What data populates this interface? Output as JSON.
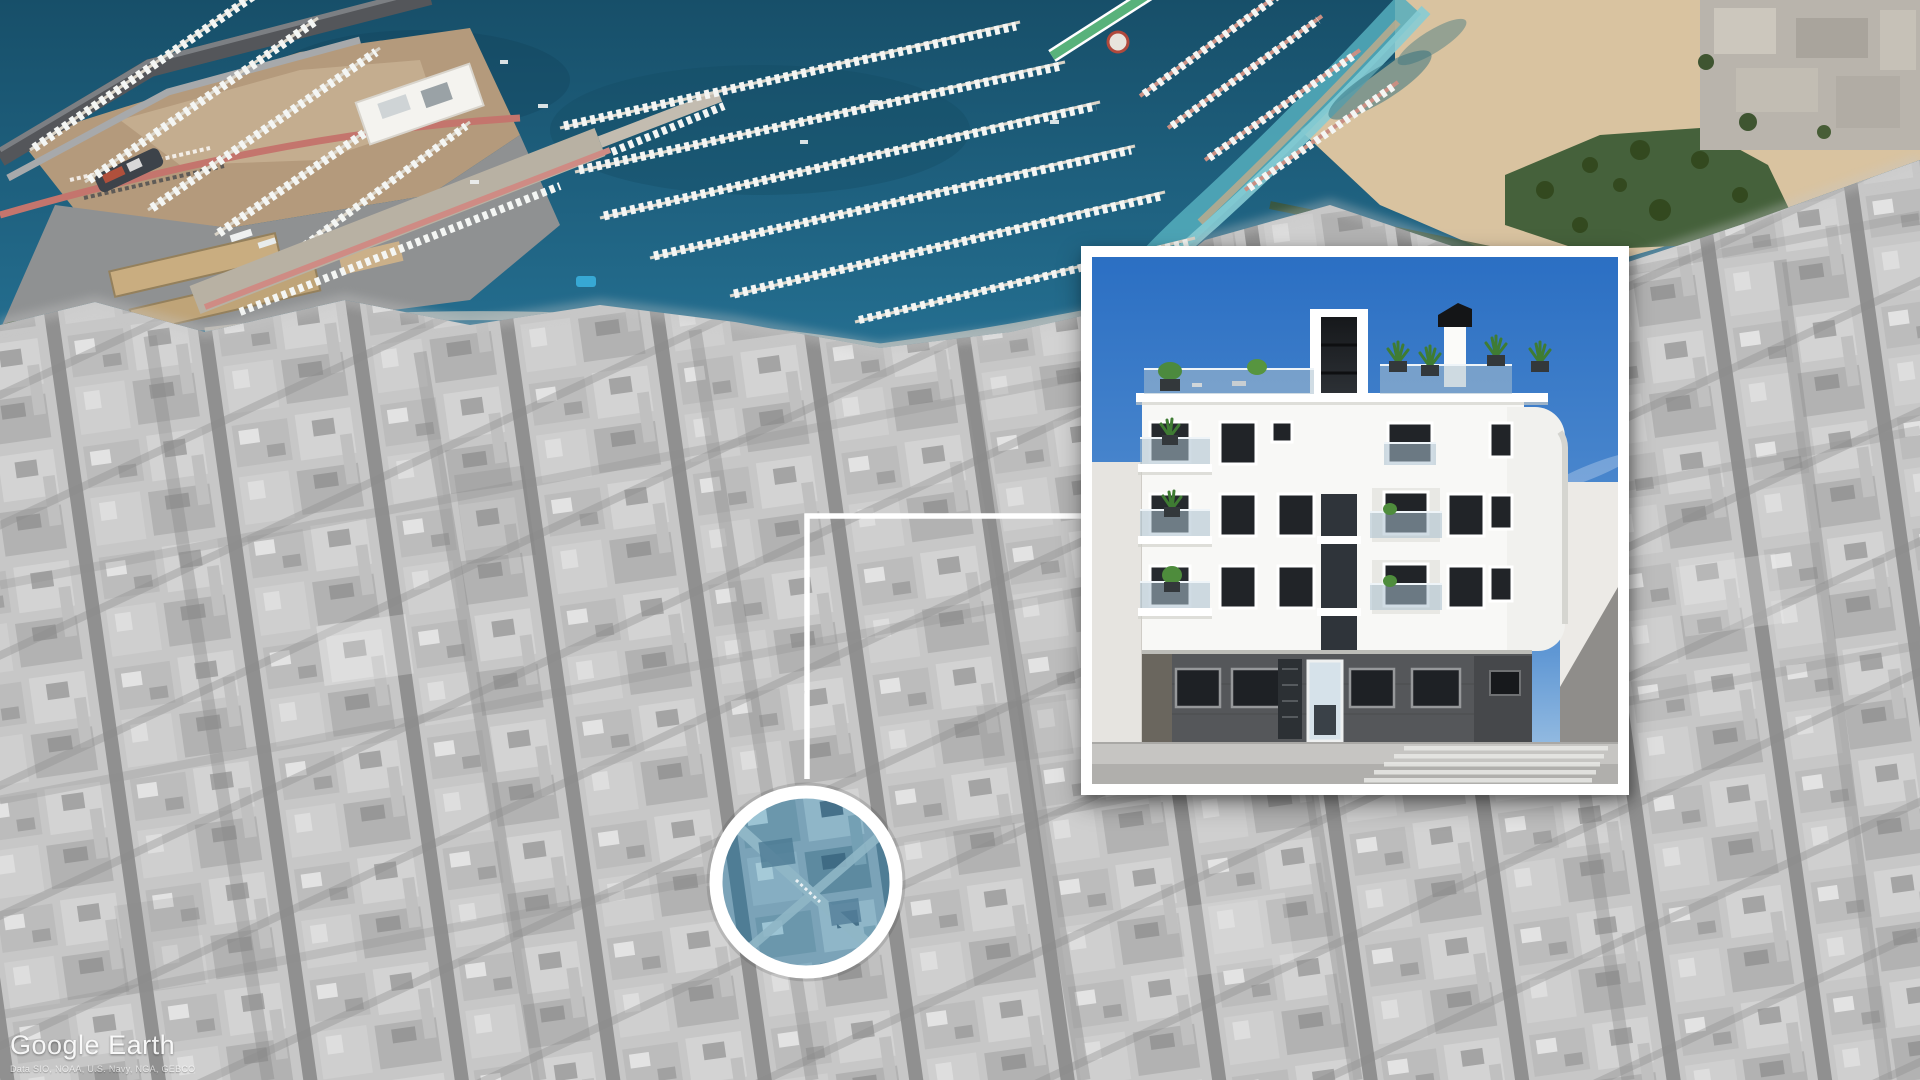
{
  "watermark": {
    "brand": "Google Earth",
    "attribution": "Data SIO, NOAA, U.S. Navy, NGA, GEBCO"
  },
  "map": {
    "kind": "oblique-aerial-satellite",
    "city_style": "desaturated-grayscale",
    "coast_style": "full-color",
    "features": [
      "harbor-marinas",
      "breakwater",
      "port-docks",
      "beach",
      "park",
      "dense-city-blocks"
    ],
    "colors": {
      "water_deep": "#174f69",
      "water_mid": "#257092",
      "water_shallow": "#55aebd",
      "sand": "#d9c3a0",
      "park_green": "#45613b",
      "city_gray": "#c7c7c7",
      "port_dirt": "#b49a7c",
      "red_quay_road": "#c4756d",
      "green_pier": "#58b27b",
      "boat_white": "#f4f6f4"
    }
  },
  "location_marker": {
    "shape": "circle",
    "ring_color": "#ffffff",
    "tint_color": "#5d89a5"
  },
  "callout_frame": {
    "shape": "open-rectangle",
    "color": "#ffffff"
  },
  "inset": {
    "kind": "architectural-render",
    "subject": "modern white apartment building with roof terrace plants, central glass stair tower, dark stone ground floor and glass entry door",
    "border_color": "#ffffff",
    "sky_color": "#2b6fc3",
    "facade_color": "#f8f8f6",
    "ground_floor_color": "#55575a"
  }
}
